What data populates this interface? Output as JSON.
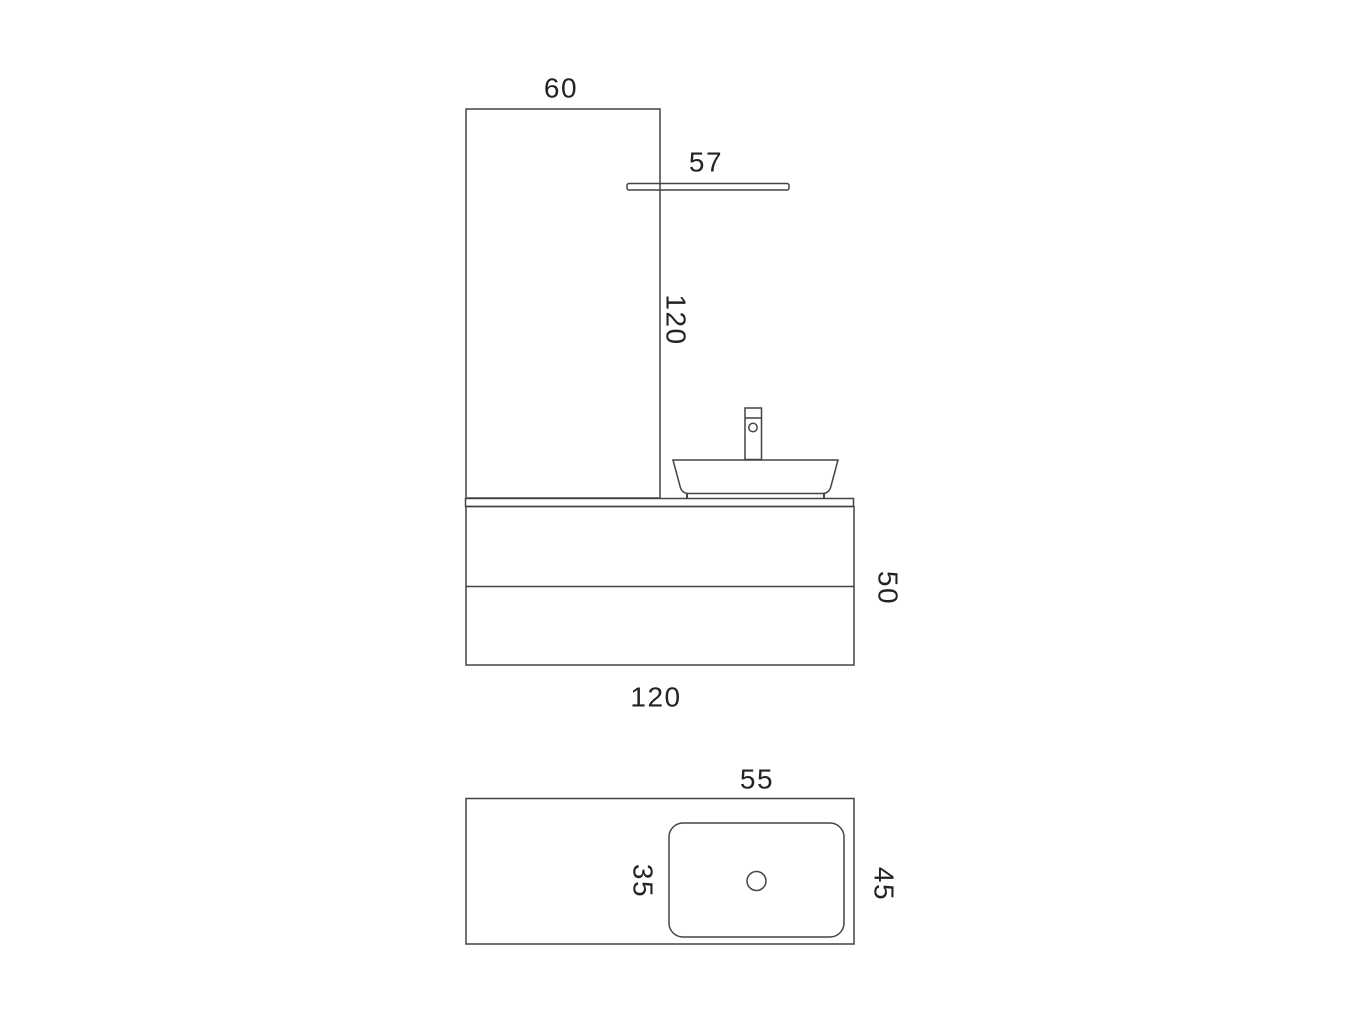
{
  "front_view": {
    "panel_width": "60",
    "shelf_width": "57",
    "panel_height": "120",
    "cabinet_height": "50",
    "cabinet_width": "120"
  },
  "top_view": {
    "basin_width": "55",
    "basin_depth": "35",
    "counter_depth": "45"
  },
  "colors": {
    "line": "#444444",
    "text": "#232323",
    "background": "#ffffff"
  }
}
